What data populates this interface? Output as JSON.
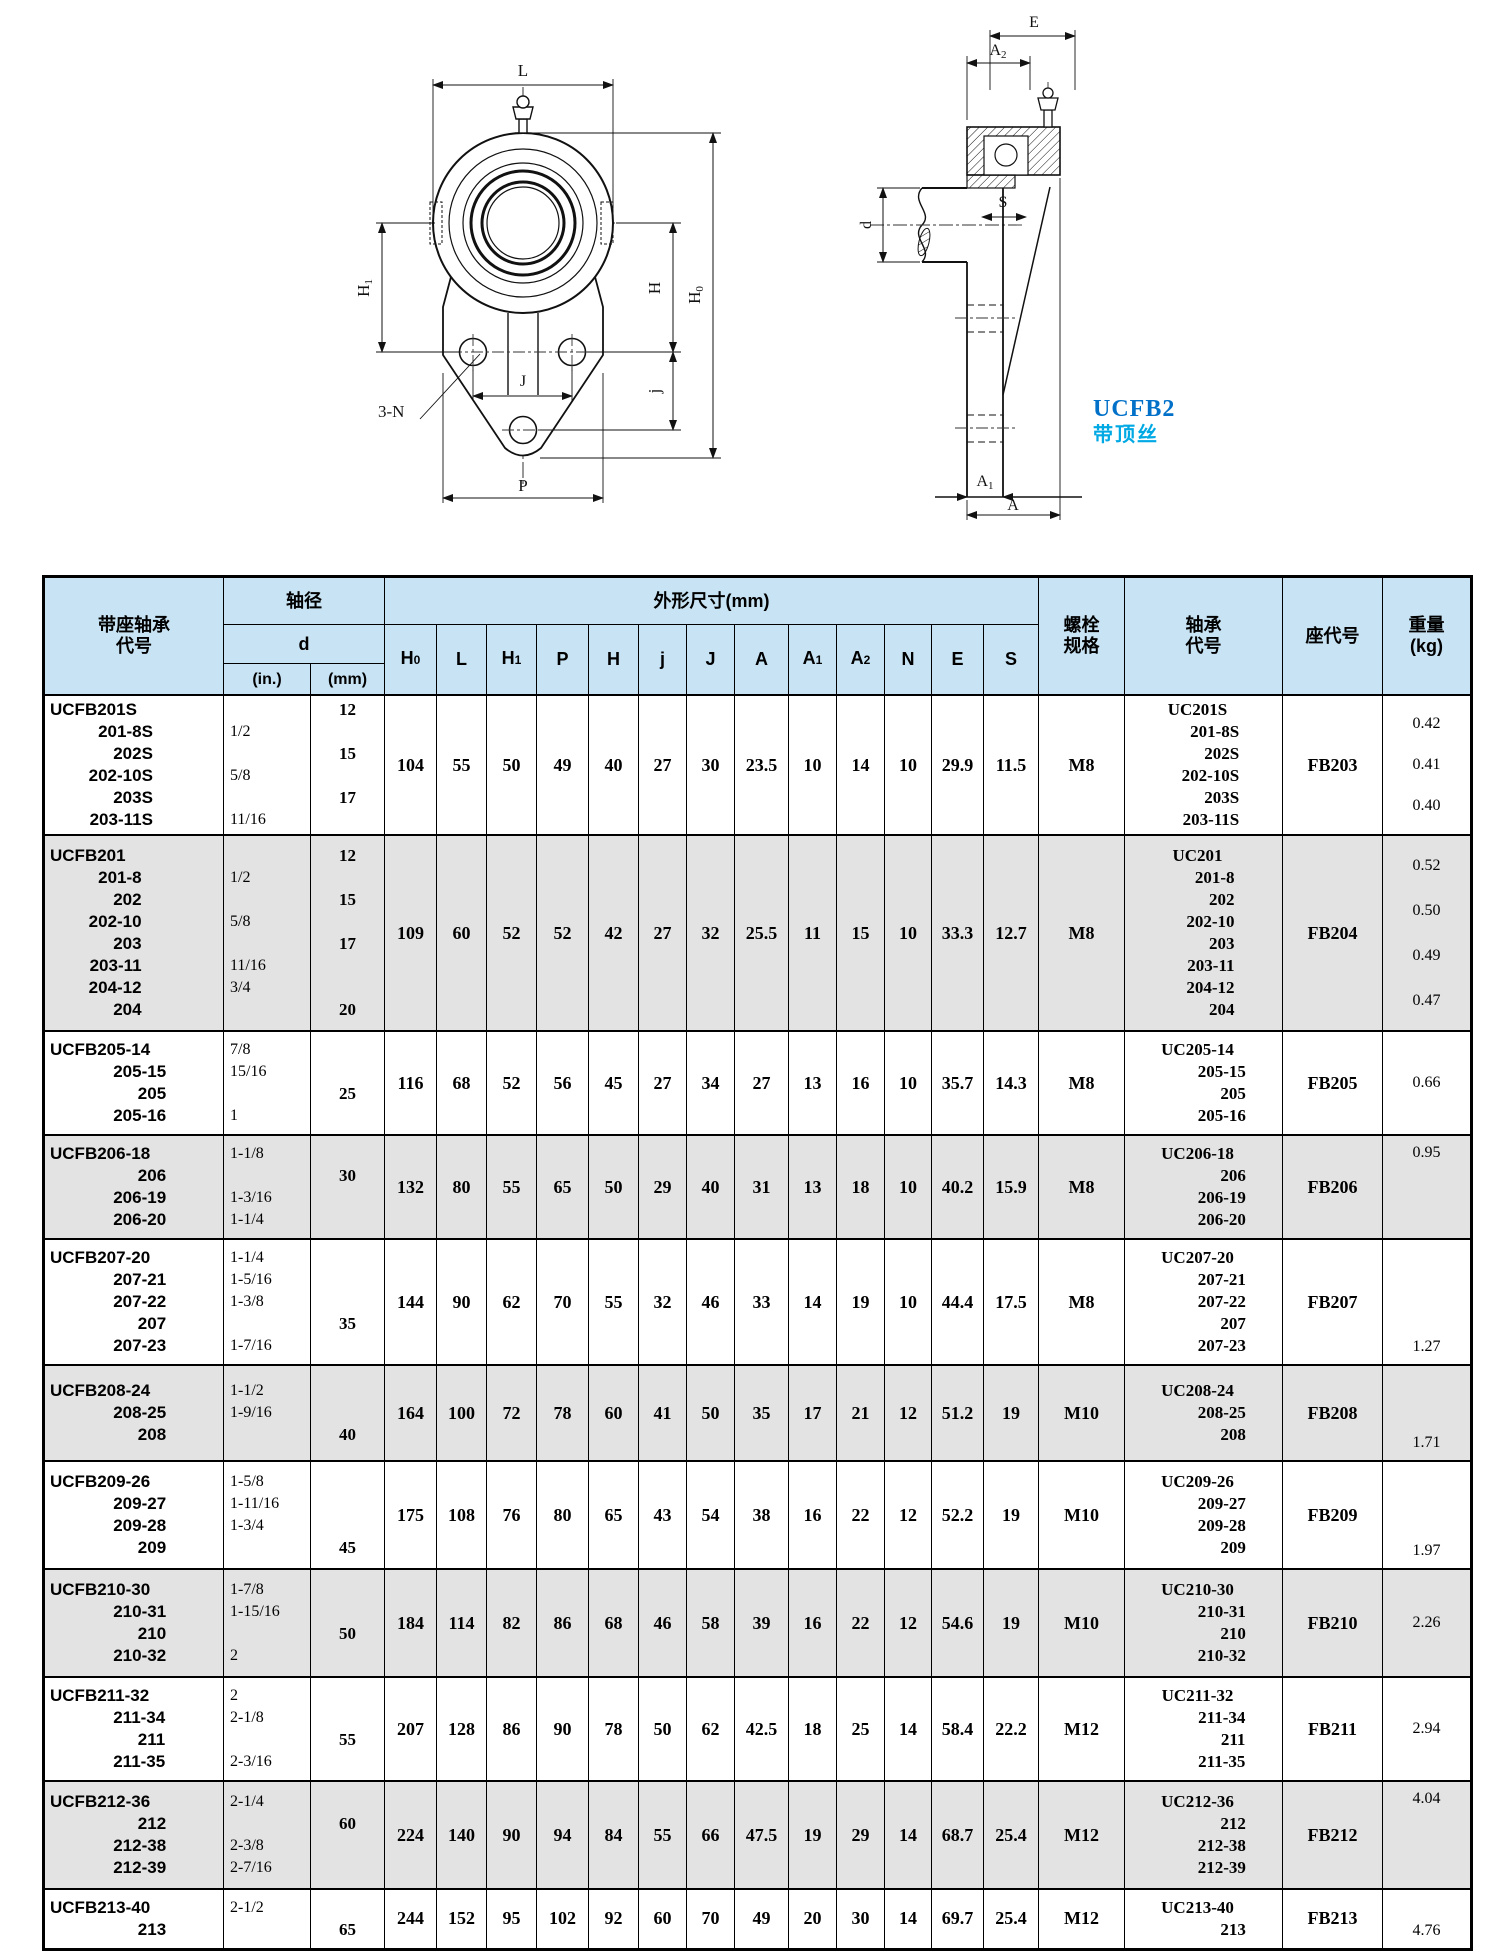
{
  "page": {
    "series_label": "UCFB2",
    "series_sublabel": "带顶丝"
  },
  "colors": {
    "header_bg": "#c8e4f4",
    "shaded_row_bg": "#e3e3e3",
    "series_blue": "#0070c9",
    "series_cyan": "#00a9e4"
  },
  "diagram": {
    "front": {
      "L": "L",
      "H1": [
        "H",
        "1"
      ],
      "threeN": "3-N",
      "J": "J",
      "jj": "j",
      "H": "H",
      "H0": [
        "H",
        "0"
      ],
      "P": "P"
    },
    "side": {
      "E": "E",
      "A2": [
        "A",
        "2"
      ],
      "S": "S",
      "d": "d",
      "A1": [
        "A",
        "1"
      ],
      "A": "A"
    }
  },
  "table": {
    "headers": {
      "unit_code_l1": "带座轴承",
      "unit_code_l2": "代号",
      "shaft_dia": "轴径",
      "d": "d",
      "in": "(in.)",
      "mm": "(mm)",
      "dims_group": "外形尺寸(mm)",
      "dim_cols": [
        {
          "main": "H",
          "sub": "0"
        },
        {
          "main": "L",
          "sub": ""
        },
        {
          "main": "H",
          "sub": "1"
        },
        {
          "main": "P",
          "sub": ""
        },
        {
          "main": "H",
          "sub": ""
        },
        {
          "main": "j",
          "sub": ""
        },
        {
          "main": "J",
          "sub": ""
        },
        {
          "main": "A",
          "sub": ""
        },
        {
          "main": "A",
          "sub": "1"
        },
        {
          "main": "A",
          "sub": "2"
        },
        {
          "main": "N",
          "sub": ""
        },
        {
          "main": "E",
          "sub": ""
        },
        {
          "main": "S",
          "sub": ""
        }
      ],
      "bolt_l1": "螺栓",
      "bolt_l2": "规格",
      "bearing_l1": "轴承",
      "bearing_l2": "代号",
      "housing": "座代号",
      "weight_l1": "重量",
      "weight_l2": "(kg)"
    },
    "rows": [
      {
        "codes": [
          "UCFB201S",
          "201-8S",
          "202S",
          "202-10S",
          "203S",
          "203-11S"
        ],
        "in": [
          "",
          "1/2",
          "",
          "5/8",
          "",
          "11/16"
        ],
        "mm": [
          "12",
          "",
          "15",
          "",
          "17",
          ""
        ],
        "dims": [
          "104",
          "55",
          "50",
          "49",
          "40",
          "27",
          "30",
          "23.5",
          "10",
          "14",
          "10",
          "29.9",
          "11.5"
        ],
        "bolt": "M8",
        "bearing": [
          "UC201S",
          "201-8S",
          "202S",
          "202-10S",
          "203S",
          "203-11S"
        ],
        "housing": "FB203",
        "weights": [
          "0.42",
          "0.41",
          "0.40"
        ],
        "wpos": "spread",
        "shaded": false,
        "h": 140
      },
      {
        "codes": [
          "UCFB201",
          "201-8",
          "202",
          "202-10",
          "203",
          "203-11",
          "204-12",
          "204"
        ],
        "in": [
          "",
          "1/2",
          "",
          "5/8",
          "",
          "11/16",
          "3/4",
          ""
        ],
        "mm": [
          "12",
          "",
          "15",
          "",
          "17",
          "",
          "",
          "20"
        ],
        "dims": [
          "109",
          "60",
          "52",
          "52",
          "42",
          "27",
          "32",
          "25.5",
          "11",
          "15",
          "10",
          "33.3",
          "12.7"
        ],
        "bolt": "M8",
        "bearing": [
          "UC201",
          "201-8",
          "202",
          "202-10",
          "203",
          "203-11",
          "204-12",
          "204"
        ],
        "housing": "FB204",
        "weights": [
          "0.52",
          "0.50",
          "0.49",
          "0.47"
        ],
        "wpos": "spread",
        "shaded": true,
        "h": 196
      },
      {
        "codes": [
          "UCFB205-14",
          "205-15",
          "205",
          "205-16"
        ],
        "in": [
          "7/8",
          "15/16",
          "",
          "1"
        ],
        "mm": [
          "",
          "",
          "25",
          ""
        ],
        "dims": [
          "116",
          "68",
          "52",
          "56",
          "45",
          "27",
          "34",
          "27",
          "13",
          "16",
          "10",
          "35.7",
          "14.3"
        ],
        "bolt": "M8",
        "bearing": [
          "UC205-14",
          "205-15",
          "205",
          "205-16"
        ],
        "housing": "FB205",
        "weights": [
          "0.66"
        ],
        "wpos": "mid",
        "shaded": false,
        "h": 104
      },
      {
        "codes": [
          "UCFB206-18",
          "206",
          "206-19",
          "206-20"
        ],
        "in": [
          "1-1/8",
          "",
          "1-3/16",
          "1-1/4"
        ],
        "mm": [
          "",
          "30",
          "",
          ""
        ],
        "dims": [
          "132",
          "80",
          "55",
          "65",
          "50",
          "29",
          "40",
          "31",
          "13",
          "18",
          "10",
          "40.2",
          "15.9"
        ],
        "bolt": "M8",
        "bearing": [
          "UC206-18",
          "206",
          "206-19",
          "206-20"
        ],
        "housing": "FB206",
        "weights": [
          "0.95"
        ],
        "wpos": "top",
        "shaded": true,
        "h": 104
      },
      {
        "codes": [
          "UCFB207-20",
          "207-21",
          "207-22",
          "207",
          "207-23"
        ],
        "in": [
          "1-1/4",
          "1-5/16",
          "1-3/8",
          "",
          "1-7/16"
        ],
        "mm": [
          "",
          "",
          "",
          "35",
          ""
        ],
        "dims": [
          "144",
          "90",
          "62",
          "70",
          "55",
          "32",
          "46",
          "33",
          "14",
          "19",
          "10",
          "44.4",
          "17.5"
        ],
        "bolt": "M8",
        "bearing": [
          "UC207-20",
          "207-21",
          "207-22",
          "207",
          "207-23"
        ],
        "housing": "FB207",
        "weights": [
          "1.27"
        ],
        "wpos": "bot",
        "shaded": false,
        "h": 126
      },
      {
        "codes": [
          "UCFB208-24",
          "208-25",
          "208"
        ],
        "in": [
          "1-1/2",
          "1-9/16",
          ""
        ],
        "mm": [
          "",
          "",
          "40"
        ],
        "dims": [
          "164",
          "100",
          "72",
          "78",
          "60",
          "41",
          "50",
          "35",
          "17",
          "21",
          "12",
          "51.2",
          "19"
        ],
        "bolt": "M10",
        "bearing": [
          "UC208-24",
          "208-25",
          "208"
        ],
        "housing": "FB208",
        "weights": [
          "1.71"
        ],
        "wpos": "bot",
        "shaded": true,
        "h": 96
      },
      {
        "codes": [
          "UCFB209-26",
          "209-27",
          "209-28",
          "209"
        ],
        "in": [
          "1-5/8",
          "1-11/16",
          "1-3/4",
          ""
        ],
        "mm": [
          "",
          "",
          "",
          "45"
        ],
        "dims": [
          "175",
          "108",
          "76",
          "80",
          "65",
          "43",
          "54",
          "38",
          "16",
          "22",
          "12",
          "52.2",
          "19"
        ],
        "bolt": "M10",
        "bearing": [
          "UC209-26",
          "209-27",
          "209-28",
          "209"
        ],
        "housing": "FB209",
        "weights": [
          "1.97"
        ],
        "wpos": "bot",
        "shaded": false,
        "h": 108
      },
      {
        "codes": [
          "UCFB210-30",
          "210-31",
          "210",
          "210-32"
        ],
        "in": [
          "1-7/8",
          "1-15/16",
          "",
          "2"
        ],
        "mm": [
          "",
          "",
          "50",
          ""
        ],
        "dims": [
          "184",
          "114",
          "82",
          "86",
          "68",
          "46",
          "58",
          "39",
          "16",
          "22",
          "12",
          "54.6",
          "19"
        ],
        "bolt": "M10",
        "bearing": [
          "UC210-30",
          "210-31",
          "210",
          "210-32"
        ],
        "housing": "FB210",
        "weights": [
          "2.26"
        ],
        "wpos": "mid",
        "shaded": true,
        "h": 108
      },
      {
        "codes": [
          "UCFB211-32",
          "211-34",
          "211",
          "211-35"
        ],
        "in": [
          "2",
          "2-1/8",
          "",
          "2-3/16"
        ],
        "mm": [
          "",
          "",
          "55",
          ""
        ],
        "dims": [
          "207",
          "128",
          "86",
          "90",
          "78",
          "50",
          "62",
          "42.5",
          "18",
          "25",
          "14",
          "58.4",
          "22.2"
        ],
        "bolt": "M12",
        "bearing": [
          "UC211-32",
          "211-34",
          "211",
          "211-35"
        ],
        "housing": "FB211",
        "weights": [
          "2.94"
        ],
        "wpos": "mid",
        "shaded": false,
        "h": 104
      },
      {
        "codes": [
          "UCFB212-36",
          "212",
          "212-38",
          "212-39"
        ],
        "in": [
          "2-1/4",
          "",
          "2-3/8",
          "2-7/16"
        ],
        "mm": [
          "",
          "60",
          "",
          ""
        ],
        "dims": [
          "224",
          "140",
          "90",
          "94",
          "84",
          "55",
          "66",
          "47.5",
          "19",
          "29",
          "14",
          "68.7",
          "25.4"
        ],
        "bolt": "M12",
        "bearing": [
          "UC212-36",
          "212",
          "212-38",
          "212-39"
        ],
        "housing": "FB212",
        "weights": [
          "4.04"
        ],
        "wpos": "top",
        "shaded": true,
        "h": 108
      },
      {
        "codes": [
          "UCFB213-40",
          "213"
        ],
        "in": [
          "2-1/2",
          ""
        ],
        "mm": [
          "",
          "65"
        ],
        "dims": [
          "244",
          "152",
          "95",
          "102",
          "92",
          "60",
          "70",
          "49",
          "20",
          "30",
          "14",
          "69.7",
          "25.4"
        ],
        "bolt": "M12",
        "bearing": [
          "UC213-40",
          "213"
        ],
        "housing": "FB213",
        "weights": [
          "4.76"
        ],
        "wpos": "bot",
        "shaded": false,
        "h": 60
      }
    ]
  }
}
